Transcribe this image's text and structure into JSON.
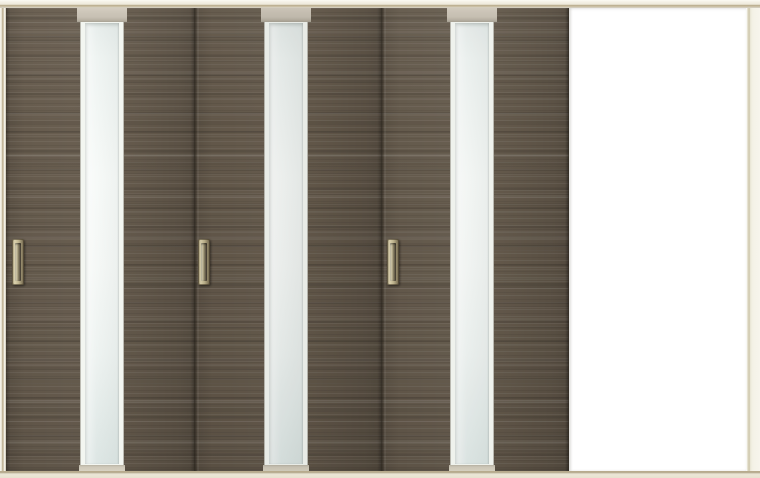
{
  "scene": {
    "type": "product-photo",
    "subject": "Three-panel interior sliding door unit, dark woodgrain panels each with a vertical frosted-glass slit and recessed pull handle, panels stacked left with the doorway open on the right",
    "panel_count": 3,
    "opening_state": "open-right"
  },
  "unit": {
    "panels": [
      {
        "id": "panel-1",
        "finish": "dark-woodgrain",
        "glass": "frosted-vertical-slit",
        "handle": "recessed-pull"
      },
      {
        "id": "panel-2",
        "finish": "dark-woodgrain",
        "glass": "frosted-vertical-slit",
        "handle": "recessed-pull"
      },
      {
        "id": "panel-3",
        "finish": "dark-woodgrain",
        "glass": "frosted-vertical-slit",
        "handle": "recessed-pull"
      }
    ]
  },
  "colors": {
    "frame_cream": "#f0ecdf",
    "frame_tan_line": "#b9ac8e",
    "wood_base": "#665b4d",
    "wood_dark": "#544b40",
    "wood_light": "#766a59",
    "glass_fill": "#eef3f1",
    "glass_bright": "#f7faf8",
    "glass_dim": "#dde6e4",
    "glass_top_cap": "#c8c1b4",
    "stile_white": "#f3f6f1",
    "handle_gold_light": "#ddd4b0",
    "handle_gold": "#bfb48e",
    "handle_gold_dark": "#6d624a",
    "handle_recess": "#4e463a",
    "opening_white": "#ffffff"
  }
}
